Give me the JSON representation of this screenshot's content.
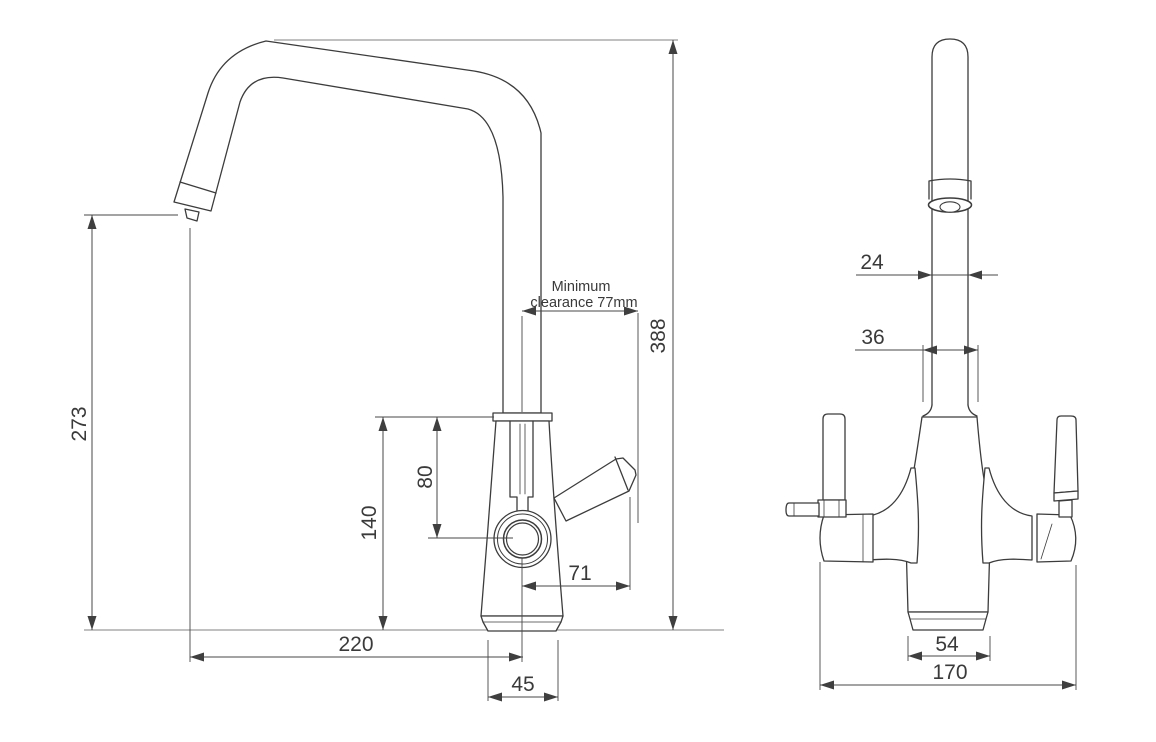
{
  "side_view": {
    "dim_273": "273",
    "dim_388": "388",
    "note_minimum": "Minimum",
    "note_clearance": "clearance 77mm",
    "dim_140": "140",
    "dim_80": "80",
    "dim_71": "71",
    "dim_220": "220",
    "dim_45": "45"
  },
  "front_view": {
    "dim_24": "24",
    "dim_36": "36",
    "dim_54": "54",
    "dim_170": "170"
  },
  "colors": {
    "line": "#3c3c3c",
    "dimension": "#474747",
    "reference": "#ababab",
    "background": "#ffffff"
  }
}
